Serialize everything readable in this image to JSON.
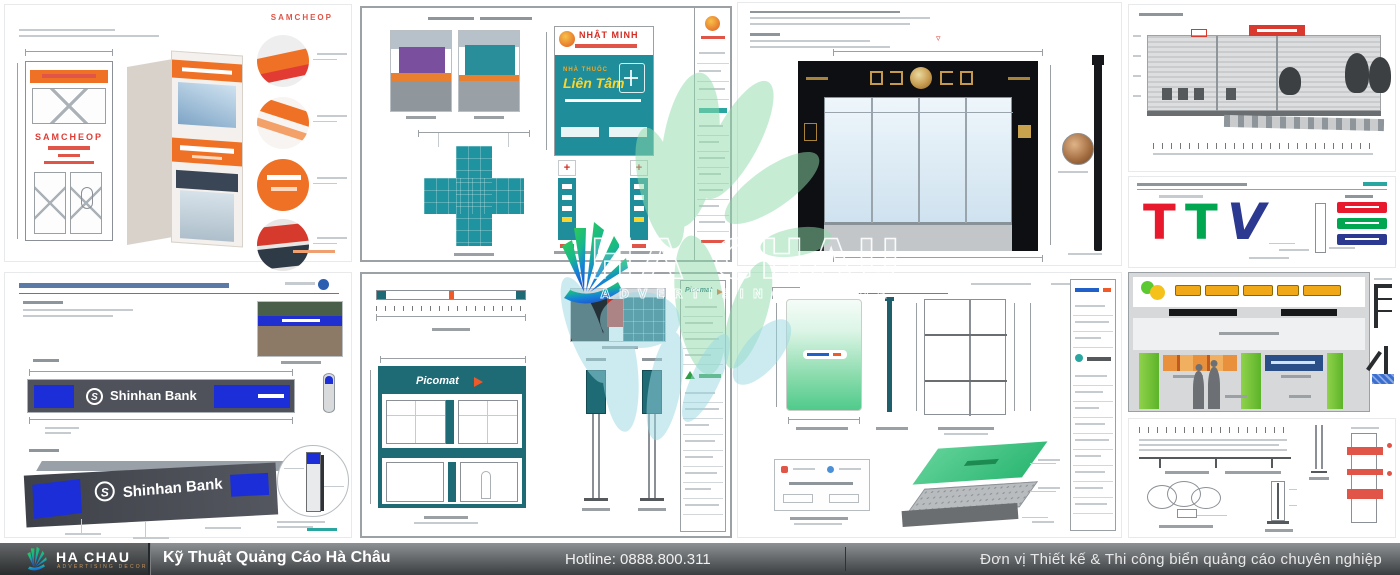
{
  "watermark": {
    "brand": "HA CHAU",
    "tagline": "ADVERTISING DECOR"
  },
  "footer": {
    "brand": "HA CHAU",
    "brand_tagline": "ADVERTISING DECOR",
    "studio": "Kỹ Thuật Quảng Cáo Hà Châu",
    "hotline": "Hotline: 0888.800.311",
    "tagline": "Đơn vị Thiết kế & Thi công biển quảng cáo chuyên nghiệp"
  },
  "panels": {
    "samcheop": {
      "corner_label": "SAMCHEOP",
      "fascia_text": "SAMCHEOP"
    },
    "pharmacy": {
      "header": "NHẬT MINH",
      "type_label": "NHÀ THUỐC",
      "name": "Liên Tâm"
    },
    "ttv": {
      "t1": "T",
      "t2": "T",
      "v": "V"
    },
    "shinhan": {
      "brand": "Shinhan Bank",
      "logo_initial": "S"
    },
    "picomat": {
      "brand": "Picomat"
    }
  },
  "colors": {
    "teal": "#1f8e9a",
    "orange": "#f07125",
    "red": "#e23b34",
    "shinhan_blue": "#1b2ed8",
    "picomat_teal": "#1e6a75",
    "green_sign": "#4fcb8b",
    "pillar_green": "#7cc832",
    "ttv_red": "#e8192c",
    "ttv_green": "#00a650",
    "ttv_blue": "#2b3990",
    "gold": "#c69a4e"
  }
}
